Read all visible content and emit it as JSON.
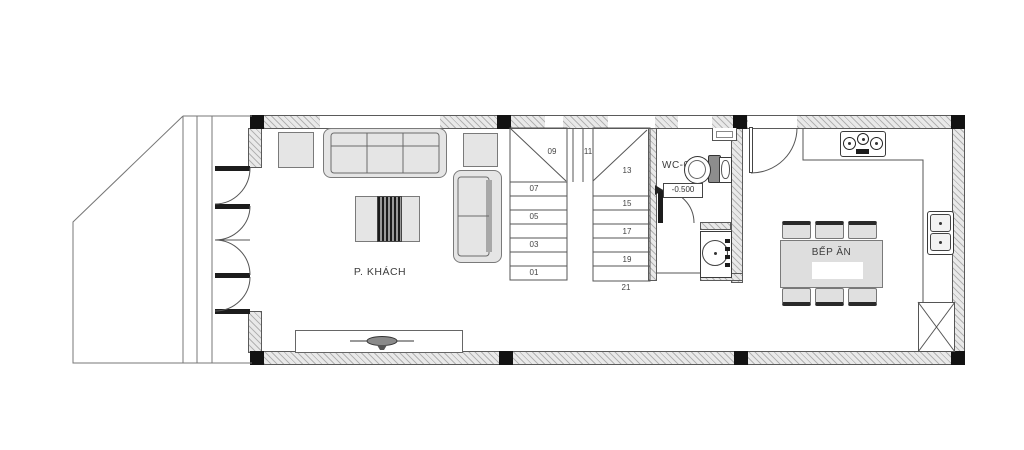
{
  "plan_title": "Ground floor plan",
  "rooms": {
    "living": {
      "label": "P. KHÁCH"
    },
    "wc": {
      "label": "WC-01",
      "level": "-0.500"
    },
    "kitchen": {
      "label": "BẾP ĂN"
    }
  },
  "stairs": {
    "treads": [
      "01",
      "03",
      "05",
      "07",
      "09",
      "11",
      "13",
      "15",
      "17",
      "19",
      "21"
    ]
  },
  "fixtures": [
    "folding-entry-door",
    "sofa-3-seat",
    "sofa-2-seat",
    "side-table",
    "coffee-table",
    "tv-cabinet",
    "toilet",
    "wash-basin",
    "washing-machine",
    "gas-stove",
    "kitchen-counter",
    "kitchen-sink",
    "dining-table",
    "dining-chair",
    "service-shaft"
  ],
  "colors": {
    "background": "#ffffff",
    "line": "#555555",
    "wall_fill": "#e9e9e9",
    "wall_hatch": "#b3b3b3",
    "column": "#121212",
    "furniture_fill": "#e5e5e5"
  }
}
